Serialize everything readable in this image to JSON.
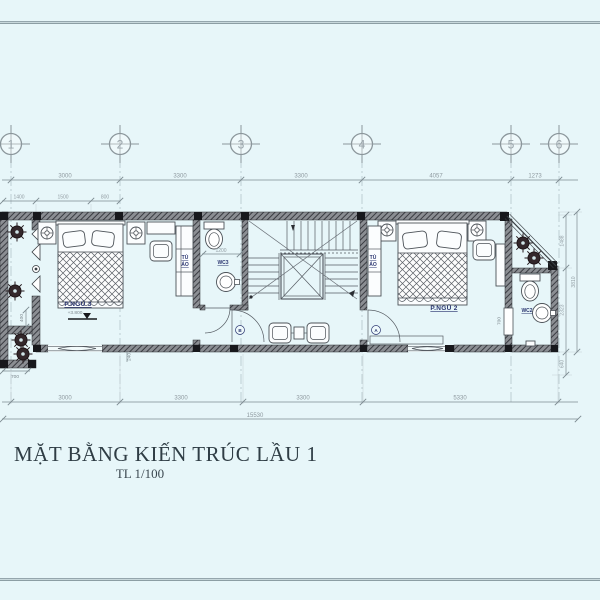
{
  "sheet": {
    "title": "MẶT BẰNG KIẾN TRÚC LẦU 1",
    "scale_note": "TL 1/100"
  },
  "grid_bubbles": [
    "1",
    "2",
    "3",
    "4",
    "5",
    "6"
  ],
  "dims": {
    "top1": [
      "3000",
      "3300",
      "3300",
      "4057",
      "1273"
    ],
    "top2": [
      "1400",
      "1500",
      "800"
    ],
    "bottom": [
      "3000",
      "3300",
      "3300",
      "5330"
    ],
    "total": "15530",
    "right_1488": "1488",
    "right_2323": "2323",
    "right_3810": "3810",
    "right_640": "640",
    "left_400": "400",
    "left_700": "700",
    "bay_240": "240",
    "wc3_1200": "1200",
    "wc2_door_700": "700"
  },
  "labels": {
    "bedroom3": "P.NGỦ 3",
    "bedroom3_level": "+3.800",
    "bedroom2": "P.NGỦ 2",
    "wc3": "WC3",
    "wc2": "WC2",
    "wardrobe_l1": "TỦ",
    "wardrobe_l2": "ÁO"
  },
  "door_tags": {
    "left": "B",
    "right": "A"
  },
  "colors": {
    "background": "#e7f6f9",
    "wall_dark": "#17181c",
    "label_blue": "#2a3570",
    "line_gray": "#8e999f"
  }
}
